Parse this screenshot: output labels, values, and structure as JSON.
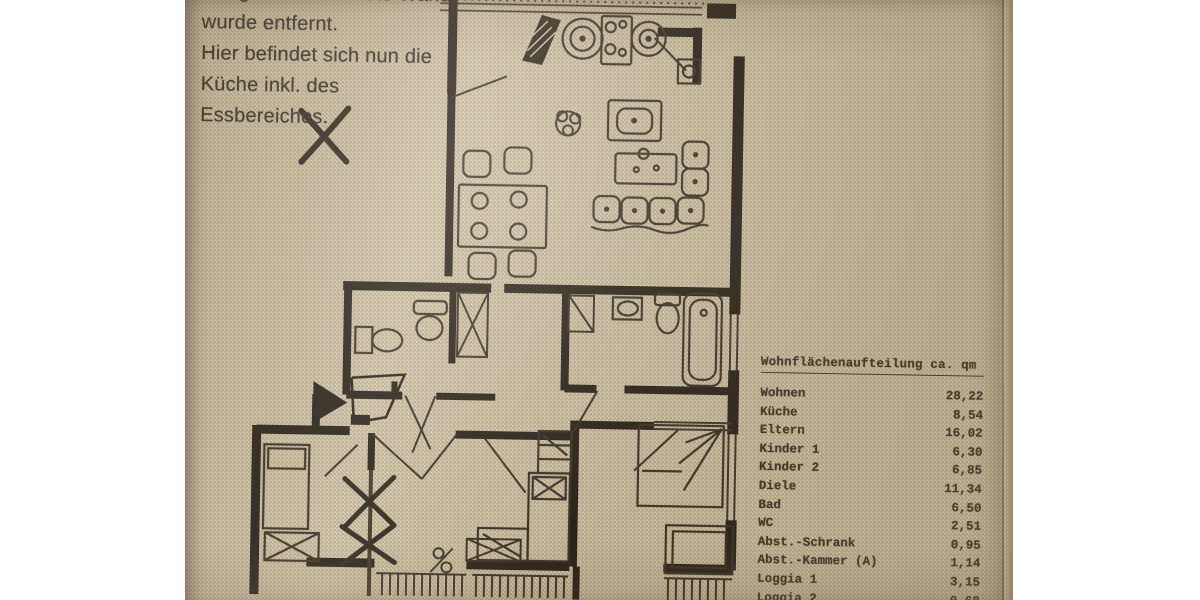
{
  "page": {
    "background_color": "#ffffff",
    "paper_color": "#cdc1a4",
    "ink_color": "#241d14",
    "text_color": "#37312a"
  },
  "note": {
    "lines": [
      "Die gekennzeichnete Wand",
      "wurde entfernt.",
      "Hier befindet sich nun die",
      "Küche inkl. des",
      "Essbereiches."
    ],
    "marker": "X"
  },
  "area_table": {
    "title": "Wohnflächenaufteilung ca. qm",
    "rows": [
      {
        "label": "Wohnen",
        "value": "28,22"
      },
      {
        "label": "Küche",
        "value": "8,54"
      },
      {
        "label": "Eltern",
        "value": "16,02"
      },
      {
        "label": "Kinder 1",
        "value": "6,30"
      },
      {
        "label": "Kinder 2",
        "value": "6,85"
      },
      {
        "label": "Diele",
        "value": "11,34"
      },
      {
        "label": "Bad",
        "value": "6,50"
      },
      {
        "label": "WC",
        "value": "2,51"
      },
      {
        "label": "Abst.-Schrank",
        "value": "0,95"
      },
      {
        "label": "Abst.-Kammer (A)",
        "value": "1,14"
      },
      {
        "label": "Loggia 1",
        "value": "3,15"
      },
      {
        "label": "Loggia 2",
        "value": "0,68"
      }
    ]
  }
}
